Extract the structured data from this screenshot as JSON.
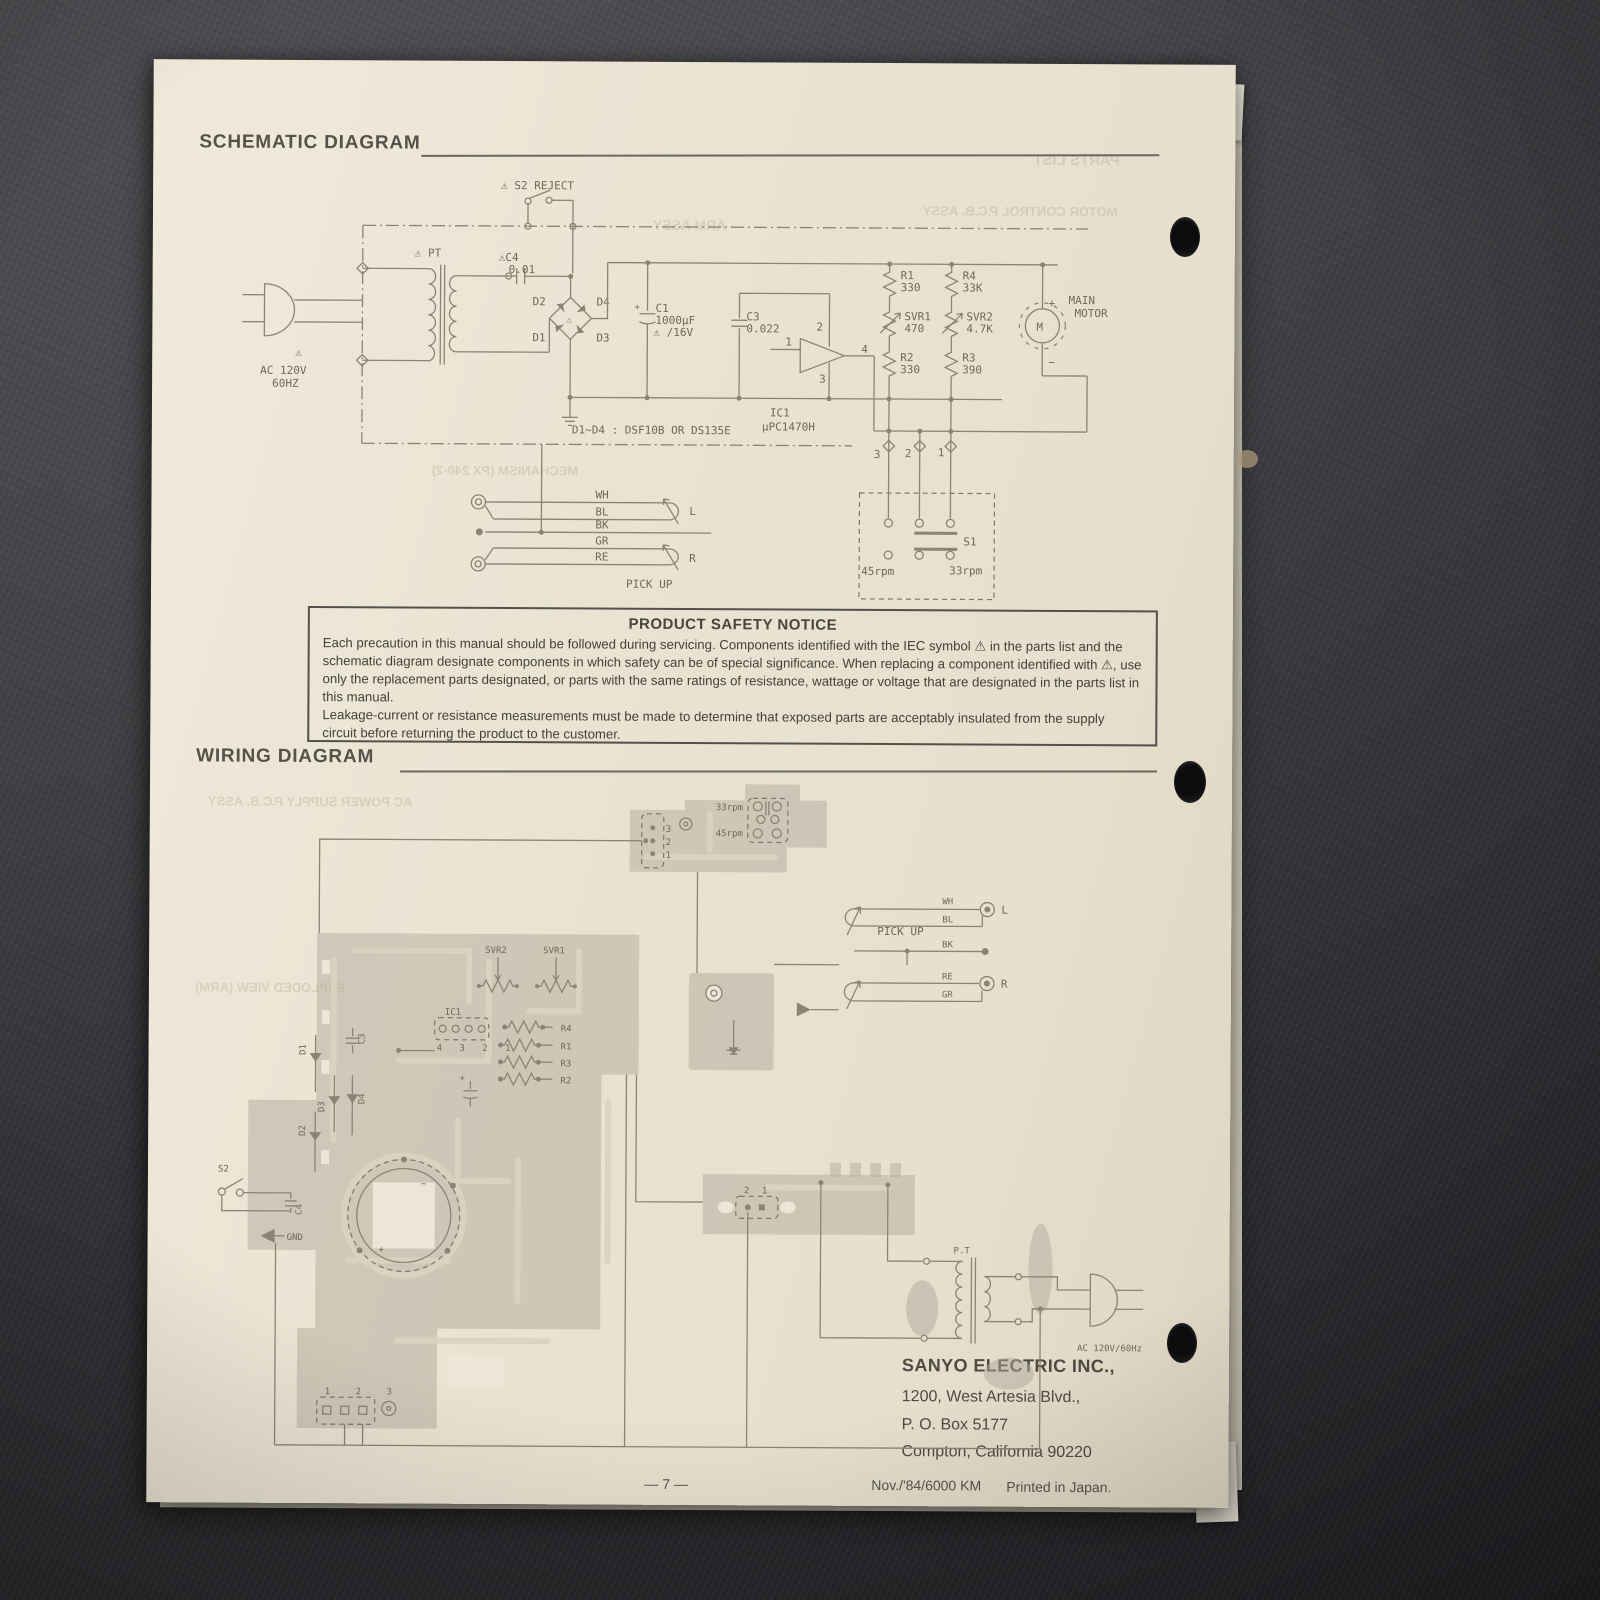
{
  "titles": {
    "schematic": "SCHEMATIC DIAGRAM",
    "wiring": "WIRING DIAGRAM"
  },
  "notice": {
    "title": "PRODUCT SAFETY NOTICE",
    "para1": "Each precaution in this manual should be followed during servicing.  Components identified with the IEC symbol ⚠ in the parts list and the schematic diagram designate components in which safety can be of special significance.  When replacing a component identified with ⚠, use only the replacement parts designated, or parts with the same ratings of resistance, wattage or voltage that are designated in the parts list in this manual.",
    "para2": "Leakage-current or resistance measurements must be made to determine that exposed parts are acceptably insulated from the supply circuit before returning the product to the customer."
  },
  "schematic": {
    "s2": "⚠ S2  REJECT",
    "pt": "⚠ PT",
    "c4": "⚠C4",
    "c4_val": "0.01",
    "ac_warn": "⚠",
    "ac1": "AC 120V",
    "ac2": "60HZ",
    "d1": "D1",
    "d2": "D2",
    "d3": "D3",
    "d4": "D4",
    "bridge_warn": "⚠",
    "c1": "C1",
    "c1_val": "1000μF",
    "c1_v": "⚠ /16V",
    "c3": "C3",
    "c3_val": "0.022",
    "p1": "1",
    "p2": "2",
    "p3": "3",
    "p4": "4",
    "ic": "IC1",
    "ic_part": "μPC1470H",
    "note": "D1~D4 : DSF10B OR DS135E",
    "r1": "R1",
    "r1_val": "330",
    "r4": "R4",
    "r4_val": "33K",
    "svr1": "SVR1",
    "svr1_val": "470",
    "svr2": "SVR2",
    "svr2_val": "4.7K",
    "r2": "R2",
    "r2_val": "330",
    "r3": "R3",
    "r3_val": "390",
    "plus": "+",
    "minus": "−",
    "m": "M",
    "main": "MAIN",
    "motor": "MOTOR",
    "t3": "3",
    "t2": "2",
    "t1": "1",
    "s1": "S1",
    "rpm45": "45rpm",
    "rpm33": "33rpm",
    "wh": "WH",
    "bl": "BL",
    "bk": "BK",
    "gr": "GR",
    "re": "RE",
    "l": "L",
    "r": "R",
    "pickup": "PICK UP"
  },
  "wiring": {
    "c3": "3",
    "c2": "2",
    "c1": "1",
    "rpm33": "33rpm",
    "rpm45": "45rpm",
    "pickup": "PICK UP",
    "wh": "WH",
    "bl": "BL",
    "bk": "BK",
    "re": "RE",
    "gr": "GR",
    "l": "L",
    "r": "R",
    "svr2": "SVR2",
    "svr1": "SVR1",
    "ic": "IC1",
    "ic_pins": "4 3 2 1",
    "r4": "R4",
    "r1": "R1",
    "r3": "R3",
    "r2": "R2",
    "d1": "D1",
    "d2": "D2",
    "d3": "D3",
    "d4": "D4",
    "cc3": "C3",
    "cc4": "C4",
    "s2": "S2",
    "gnd": "GND",
    "plus": "+",
    "minus": "−",
    "t2": "2",
    "t1": "1",
    "bconn": "1 2 3",
    "pt": "P.T",
    "ac": "AC 120V/60Hz"
  },
  "address": {
    "company": "SANYO ELECTRIC INC.,",
    "line1": "1200, West Artesia Blvd.,",
    "line2": "P. O. Box 5177",
    "line3": "Compton, California 90220"
  },
  "footer": {
    "page": "— 7 —",
    "print": "Nov./'84/6000 KM",
    "japan": "Printed in Japan."
  },
  "bleed": {
    "parts": "PARTS LIST",
    "motor_pcb": "MOTOR CONTROL P.C.B. ASSY",
    "arm": "ARM ASSY",
    "mech": "MECHANISM (PX 240-2)",
    "ac_pcb": "AC POWER SUPPLY P.C.B. ASSY",
    "exploded": "EXPLODED VIEW (ARM)"
  }
}
